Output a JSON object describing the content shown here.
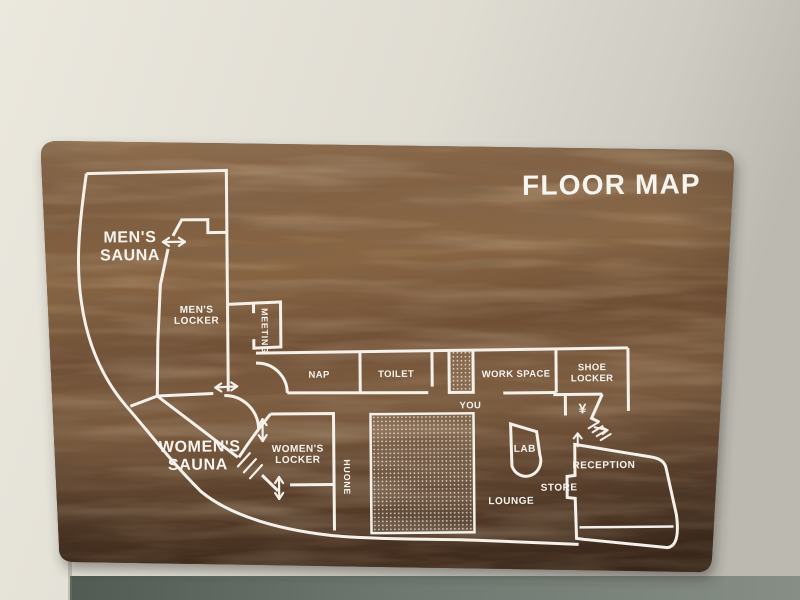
{
  "title": "FLOOR MAP",
  "rooms": {
    "mens_sauna": {
      "line1": "MEN'S",
      "line2": "SAUNA"
    },
    "mens_locker": {
      "line1": "MEN'S",
      "line2": "LOCKER"
    },
    "meeting": {
      "label": "MEETING"
    },
    "nap": {
      "label": "NAP"
    },
    "toilet": {
      "label": "TOILET"
    },
    "work_space": {
      "label": "WORK SPACE"
    },
    "shoe_locker": {
      "line1": "SHOE",
      "line2": "LOCKER"
    },
    "yen_locker": {
      "symbol": "¥"
    },
    "you": {
      "label": "YOU"
    },
    "womens_sauna": {
      "line1": "WOMEN'S",
      "line2": "SAUNA"
    },
    "womens_locker": {
      "line1": "WOMEN'S",
      "line2": "LOCKER"
    },
    "huone": {
      "label": "HUONE"
    },
    "lab": {
      "label": "LAB"
    },
    "lounge": {
      "label": "LOUNGE"
    },
    "store": {
      "label": "STORE"
    },
    "reception": {
      "label": "RECEPTION"
    }
  },
  "colors": {
    "line": "#f3f1ea",
    "text": "#f6f4ee",
    "wood_light": "#96734d",
    "wood_mid": "#7a5838",
    "wood_dark": "#4e3726",
    "wall_light": "#eae7dd",
    "wall_shaded": "#bfbcb4",
    "lower_wall": "#6b746c"
  }
}
